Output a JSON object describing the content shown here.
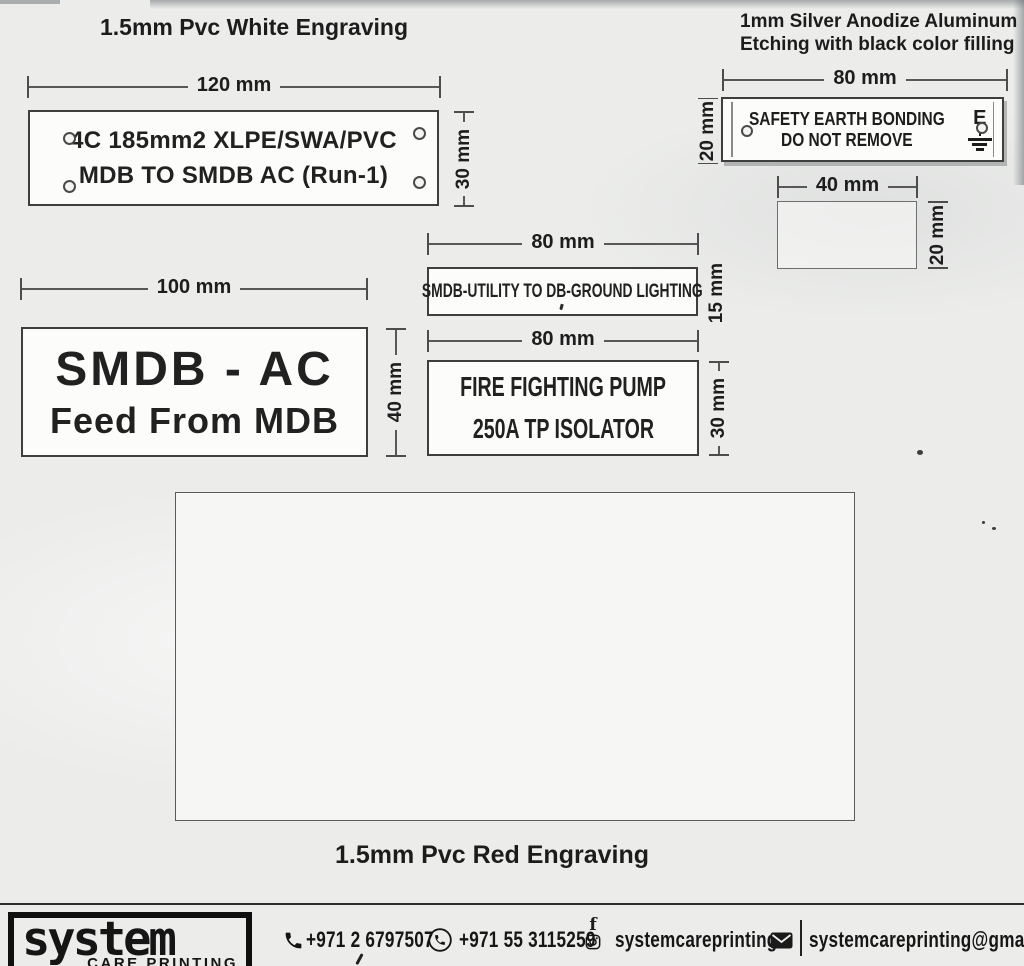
{
  "headings": {
    "pvc_white": "1.5mm  Pvc White Engraving",
    "aluminum_line1": "1mm Silver Anodize Aluminum",
    "aluminum_line2": "Etching with black color filling",
    "pvc_red": "1.5mm  Pvc Red Engraving"
  },
  "plates": {
    "mdb": {
      "width_dim": "120 mm",
      "height_dim": "30 mm",
      "line1": "4C 185mm2 XLPE/SWA/PVC",
      "line2": "MDB TO SMDB AC (Run-1)"
    },
    "safety": {
      "width_dim": "80 mm",
      "height_dim": "20 mm",
      "line1": "SAFETY EARTH BONDING",
      "line2": "DO NOT REMOVE",
      "earth_symbol_letter": "E"
    },
    "blank": {
      "width_dim": "40 mm",
      "height_dim": "20 mm"
    },
    "smdb_ac": {
      "width_dim": "100 mm",
      "height_dim": "40 mm",
      "line1": "SMDB - AC",
      "line2": "Feed From MDB"
    },
    "utility": {
      "width_dim": "80 mm",
      "height_dim": "15 mm",
      "line1": "SMDB-UTILITY TO DB-GROUND LIGHTING"
    },
    "fire": {
      "width_dim": "80 mm",
      "height_dim": "30 mm",
      "line1": "FIRE FIGHTING PUMP",
      "line2": "250A TP ISOLATOR"
    }
  },
  "footer": {
    "logo_main": "system",
    "logo_sub": "CARE PRINTING",
    "phone_landline": "+971 2 6797507",
    "phone_mobile": "+971 55 3115259",
    "social_handle": "systemcareprinting",
    "email": "systemcareprinting@gmail.com"
  },
  "colors": {
    "page_bg": "#ecedeb",
    "ink": "#1d1d1d",
    "plate_bg": "#fcfcfa",
    "line": "#4d4d4d"
  }
}
